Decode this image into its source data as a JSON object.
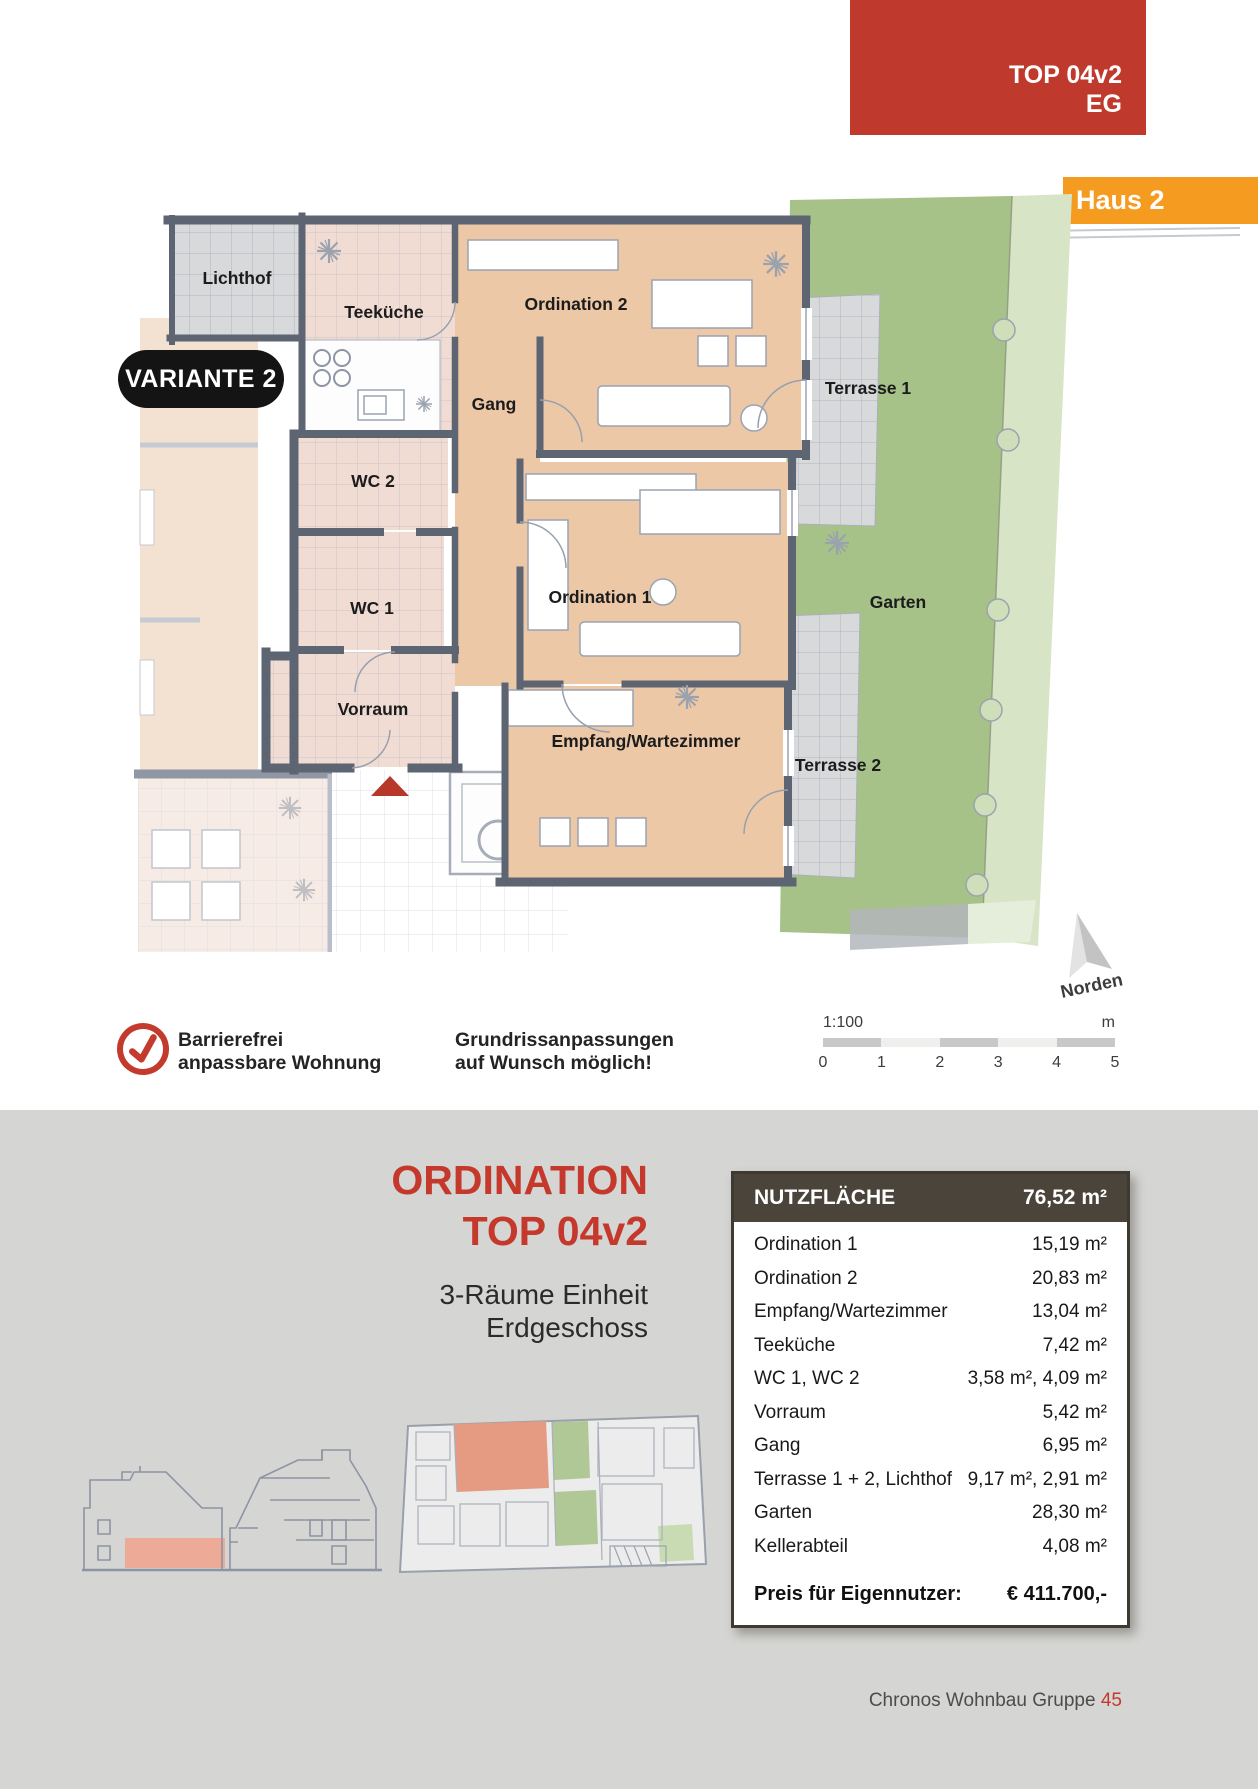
{
  "banner": {
    "line1": "TOP 04v2",
    "line2": "EG",
    "bg": "#bf3a2d"
  },
  "haus_badge": {
    "label": "Haus 2",
    "bg": "#f59c20"
  },
  "variante_badge": {
    "label": "VARIANTE 2"
  },
  "floorplan": {
    "north_label": "Norden",
    "rooms": [
      {
        "label": "Lichthof"
      },
      {
        "label": "Teeküche"
      },
      {
        "label": "Ordination 2"
      },
      {
        "label": "Gang"
      },
      {
        "label": "Terrasse 1"
      },
      {
        "label": "WC 2"
      },
      {
        "label": "WC 1"
      },
      {
        "label": "Ordination 1"
      },
      {
        "label": "Garten"
      },
      {
        "label": "Vorraum"
      },
      {
        "label": "Empfang/Wartezimmer"
      },
      {
        "label": "Terrasse 2"
      }
    ],
    "colors": {
      "room_peach": "#ecc8a7",
      "tile_pink": "#f1dcd3",
      "tile_gray": "#d8d9da",
      "garden_green": "#a6c288",
      "garden_light": "#d7e5c6",
      "wall": "#5d6472",
      "entrance_marker_red": "#b7382b"
    }
  },
  "legend": {
    "barrier_line1": "Barrierefrei",
    "barrier_line2": "anpassbare Wohnung",
    "custom_line1": "Grundrissanpassungen",
    "custom_line2": "auf Wunsch möglich!"
  },
  "scalebar": {
    "ratio": "1:100",
    "unit": "m",
    "ticks": [
      "0",
      "1",
      "2",
      "3",
      "4",
      "5"
    ]
  },
  "section": {
    "title_line1": "ORDINATION",
    "title_line2": "TOP 04v2",
    "subtitle_line1": "3-Räume Einheit",
    "subtitle_line2": "Erdgeschoss"
  },
  "table": {
    "header_label": "NUTZFLÄCHE",
    "header_value": "76,52 m²",
    "rows": [
      {
        "label": "Ordination 1",
        "value": "15,19 m²"
      },
      {
        "label": "Ordination 2",
        "value": "20,83 m²"
      },
      {
        "label": "Empfang/Wartezimmer",
        "value": "13,04 m²"
      },
      {
        "label": "Teeküche",
        "value": "7,42 m²"
      },
      {
        "label": "WC 1, WC 2",
        "value": "3,58 m², 4,09 m²"
      },
      {
        "label": "Vorraum",
        "value": "5,42 m²"
      },
      {
        "label": "Gang",
        "value": "6,95 m²"
      },
      {
        "label": "Terrasse 1 + 2, Lichthof",
        "value": "9,17 m², 2,91 m²"
      },
      {
        "label": "Garten",
        "value": "28,30 m²"
      },
      {
        "label": "Kellerabteil",
        "value": "4,08 m²"
      }
    ],
    "price_label": "Preis für Eigennutzer:",
    "price_value": "€ 411.700,-"
  },
  "footer": {
    "text": "Chronos Wohnbau Gruppe ",
    "page": "45"
  }
}
